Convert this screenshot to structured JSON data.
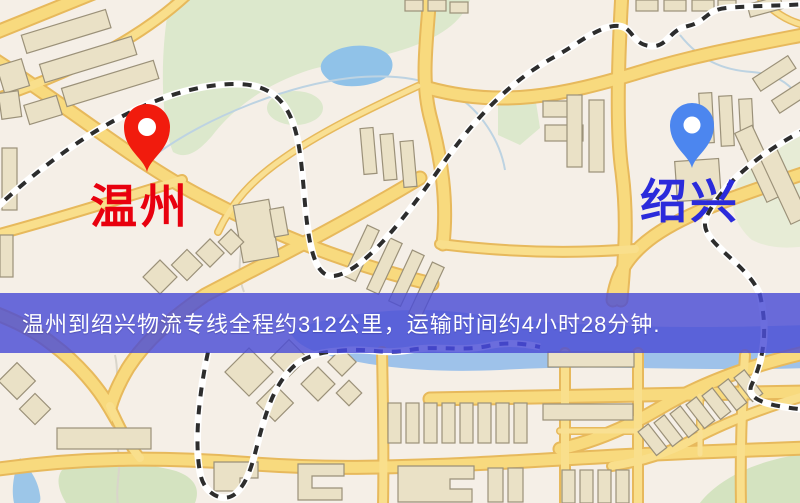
{
  "map": {
    "type": "road-map-image",
    "colors": {
      "background": "#f5efe7",
      "road": "#f8da7e",
      "road_casing": "#e7b95c",
      "park": "#dce8cc",
      "water": "#90c2e8",
      "building": "#eae1c6",
      "railway_dash": "#2d2d2d",
      "railway_dash_water": "#23238c"
    }
  },
  "markers": {
    "origin": {
      "label": "温州",
      "label_color": "#e8000e",
      "pin_color": "#f11b0d"
    },
    "destination": {
      "label": "绍兴",
      "label_color": "#2b2bdb",
      "pin_color": "#4c86ef"
    }
  },
  "banner": {
    "text": "温州到绍兴物流专线全程约312公里，运输时间约4小时28分钟.",
    "background": "#4a4dd6",
    "text_color": "#ffffff"
  }
}
